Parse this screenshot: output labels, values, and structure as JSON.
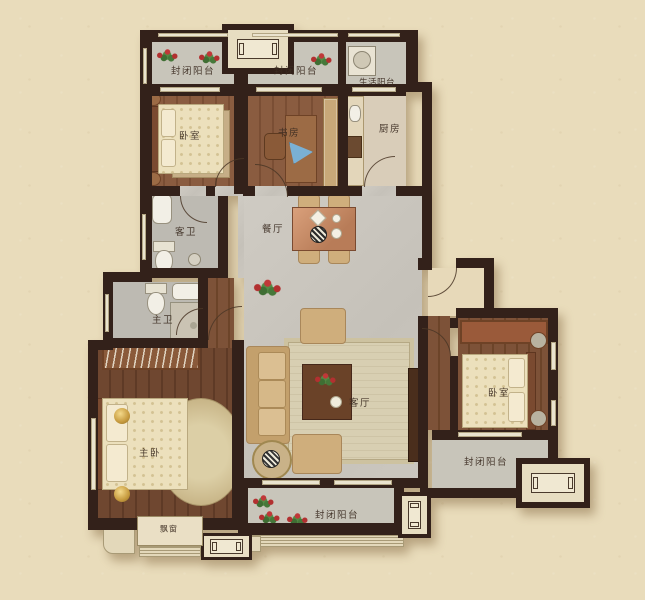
{
  "floorplan": {
    "colors": {
      "background": "#e9dcbb",
      "wall": "#33211a",
      "marble_floor": "#cbc7bf",
      "wood_floor": "#7a4e34",
      "balcony_floor": "#c8c5ba",
      "accent_bronze": "#b97f58"
    },
    "labels": {
      "balcony_top_left": "封闭阳台",
      "balcony_top_mid": "封闭阳台",
      "service_balcony": "生活阳台",
      "bedroom_top_left": "卧室",
      "study": "书房",
      "kitchen": "厨房",
      "dining_room": "餐厅",
      "guest_bathroom": "客卫",
      "master_bathroom": "主卫",
      "master_bedroom": "主卧",
      "living_room": "客厅",
      "bedroom_right": "卧室",
      "balcony_bottom": "封闭阳台",
      "balcony_right": "封闭阳台",
      "bay_window": "飘窗"
    }
  }
}
